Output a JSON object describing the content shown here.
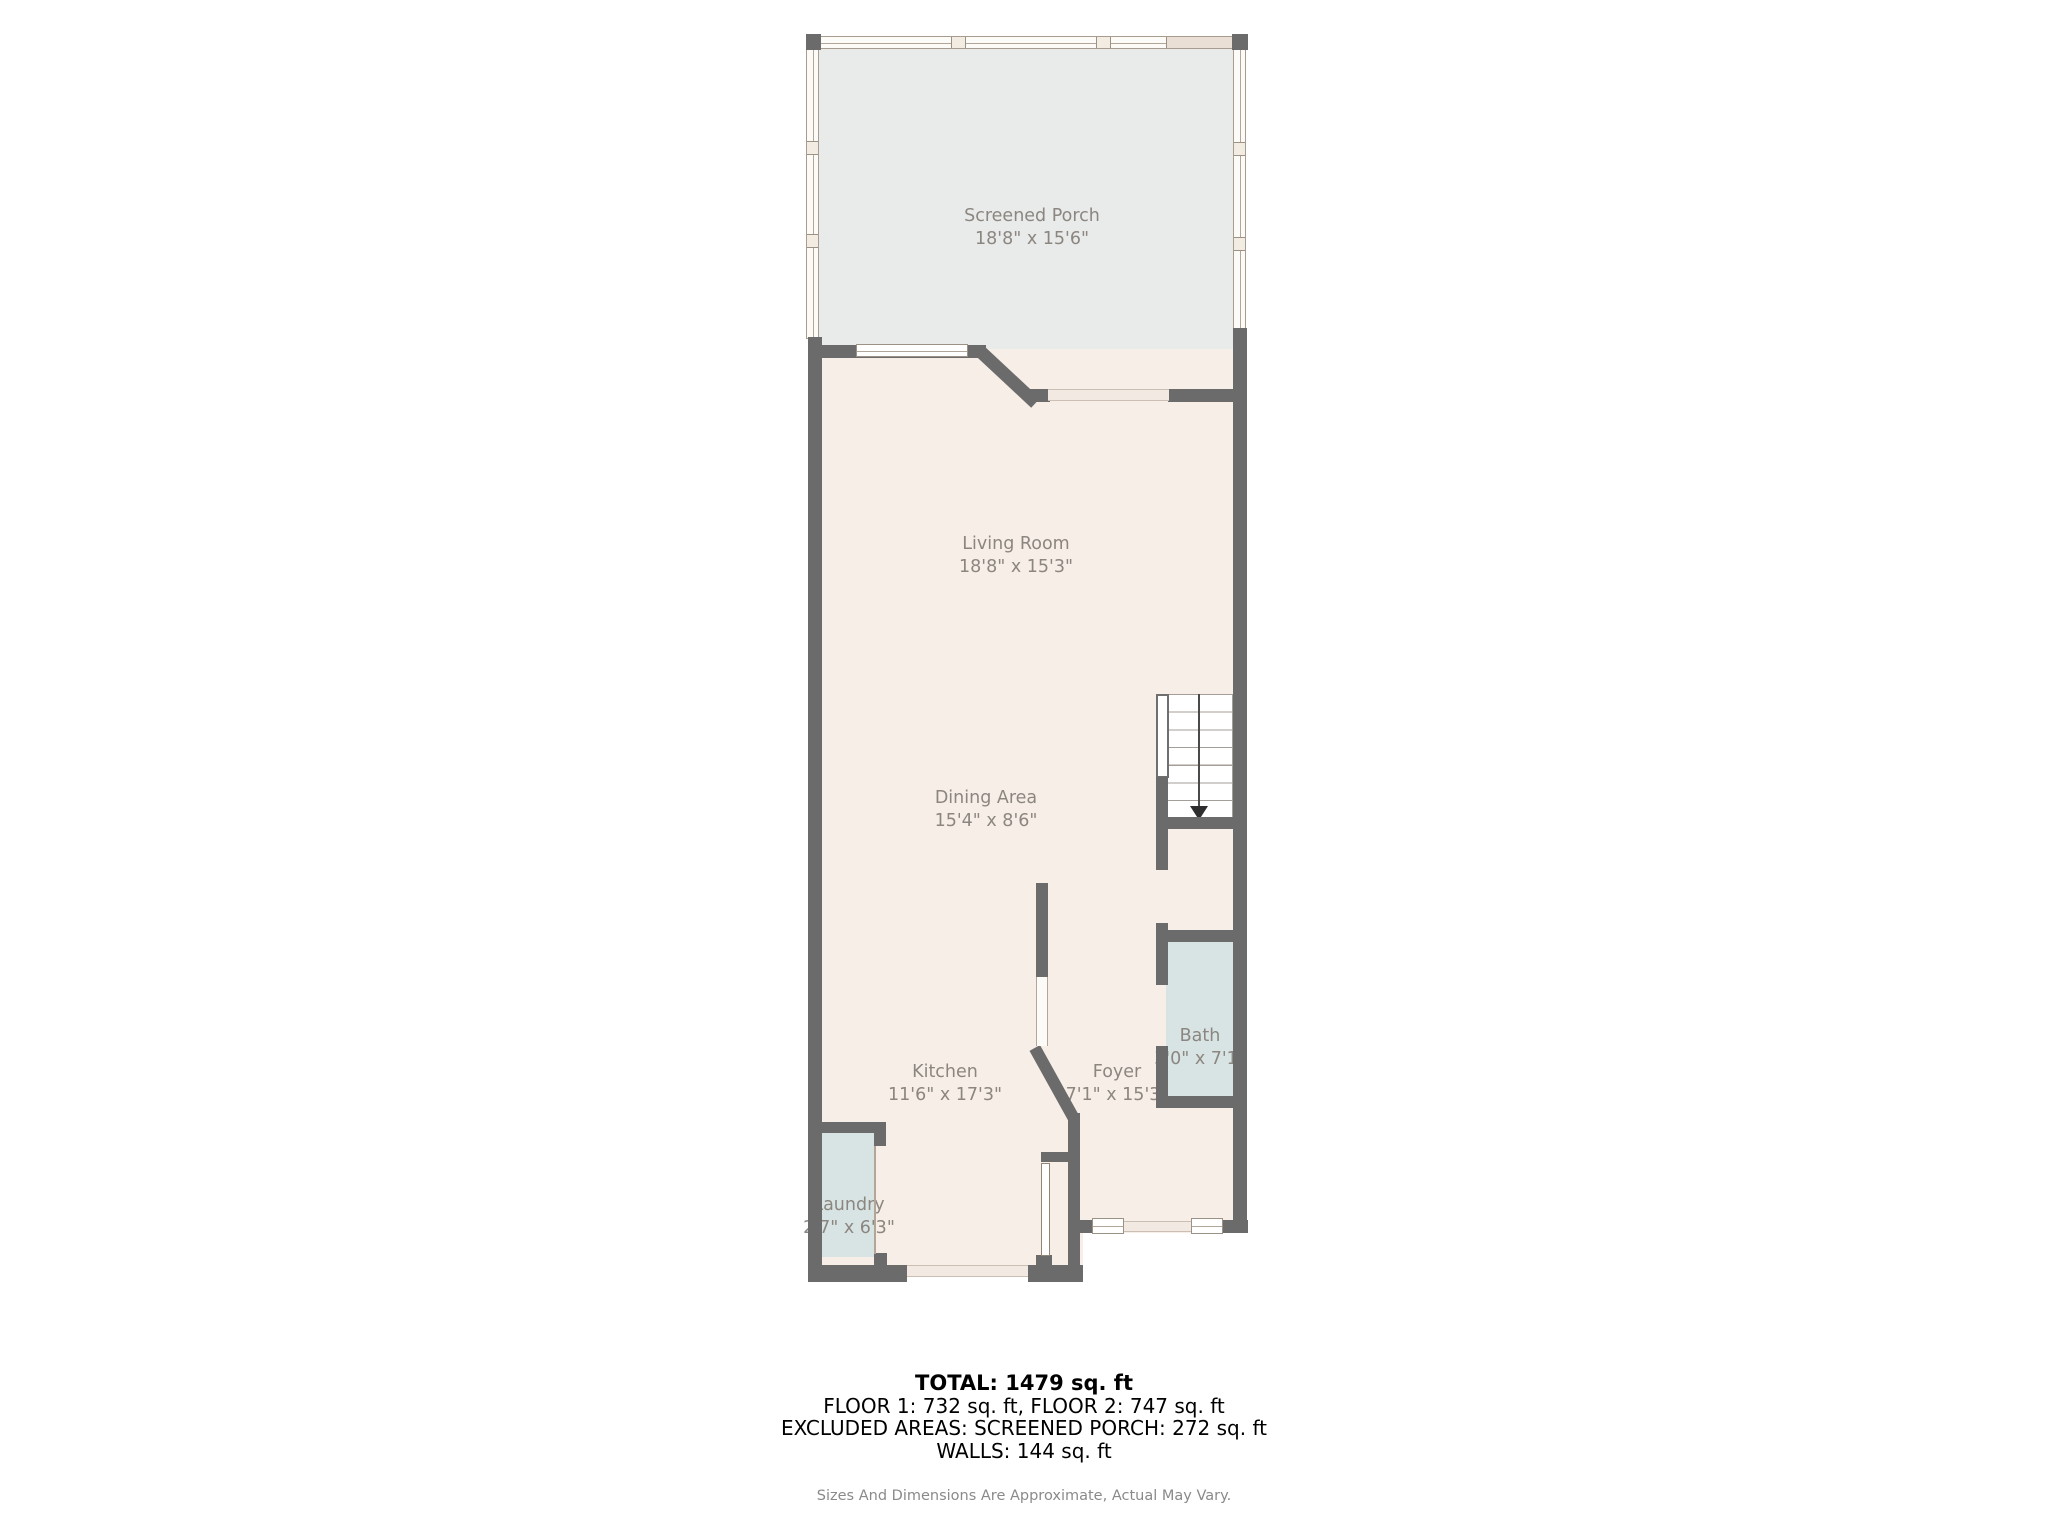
{
  "title": "First floor plan",
  "colors": {
    "wall": "#6b6b6b",
    "porch_floor": "#e9eaea",
    "interior_floor": "#f7eee7",
    "wet_room_floor": "#d8e4e4",
    "window_frame": "#a89c8e",
    "label_text": "#8b8680",
    "summary_text": "#000000",
    "disclaimer_text": "#8a8a8a",
    "background": "#ffffff"
  },
  "rooms": {
    "screened_porch": {
      "name": "Screened Porch",
      "dims": "18'8\" x 15'6\""
    },
    "living_room": {
      "name": "Living Room",
      "dims": "18'8\" x 15'3\""
    },
    "dining_area": {
      "name": "Dining Area",
      "dims": "15'4\" x 8'6\""
    },
    "kitchen": {
      "name": "Kitchen",
      "dims": "11'6\" x 17'3\""
    },
    "foyer": {
      "name": "Foyer",
      "dims": "7'1\" x 15'3\""
    },
    "bath": {
      "name": "Bath",
      "dims": "3'0\" x 7'1\""
    },
    "laundry": {
      "name": "Laundry",
      "dims": "2'7\" x 6'3\""
    }
  },
  "stairs": {
    "direction": "down"
  },
  "summary": {
    "total": "TOTAL: 1479 sq. ft",
    "floors": "FLOOR 1: 732 sq. ft, FLOOR 2: 747 sq. ft",
    "excluded": "EXCLUDED AREAS: SCREENED PORCH: 272 sq. ft",
    "walls": "WALLS: 144 sq. ft",
    "disclaimer": "Sizes And Dimensions Are Approximate, Actual May Vary."
  }
}
